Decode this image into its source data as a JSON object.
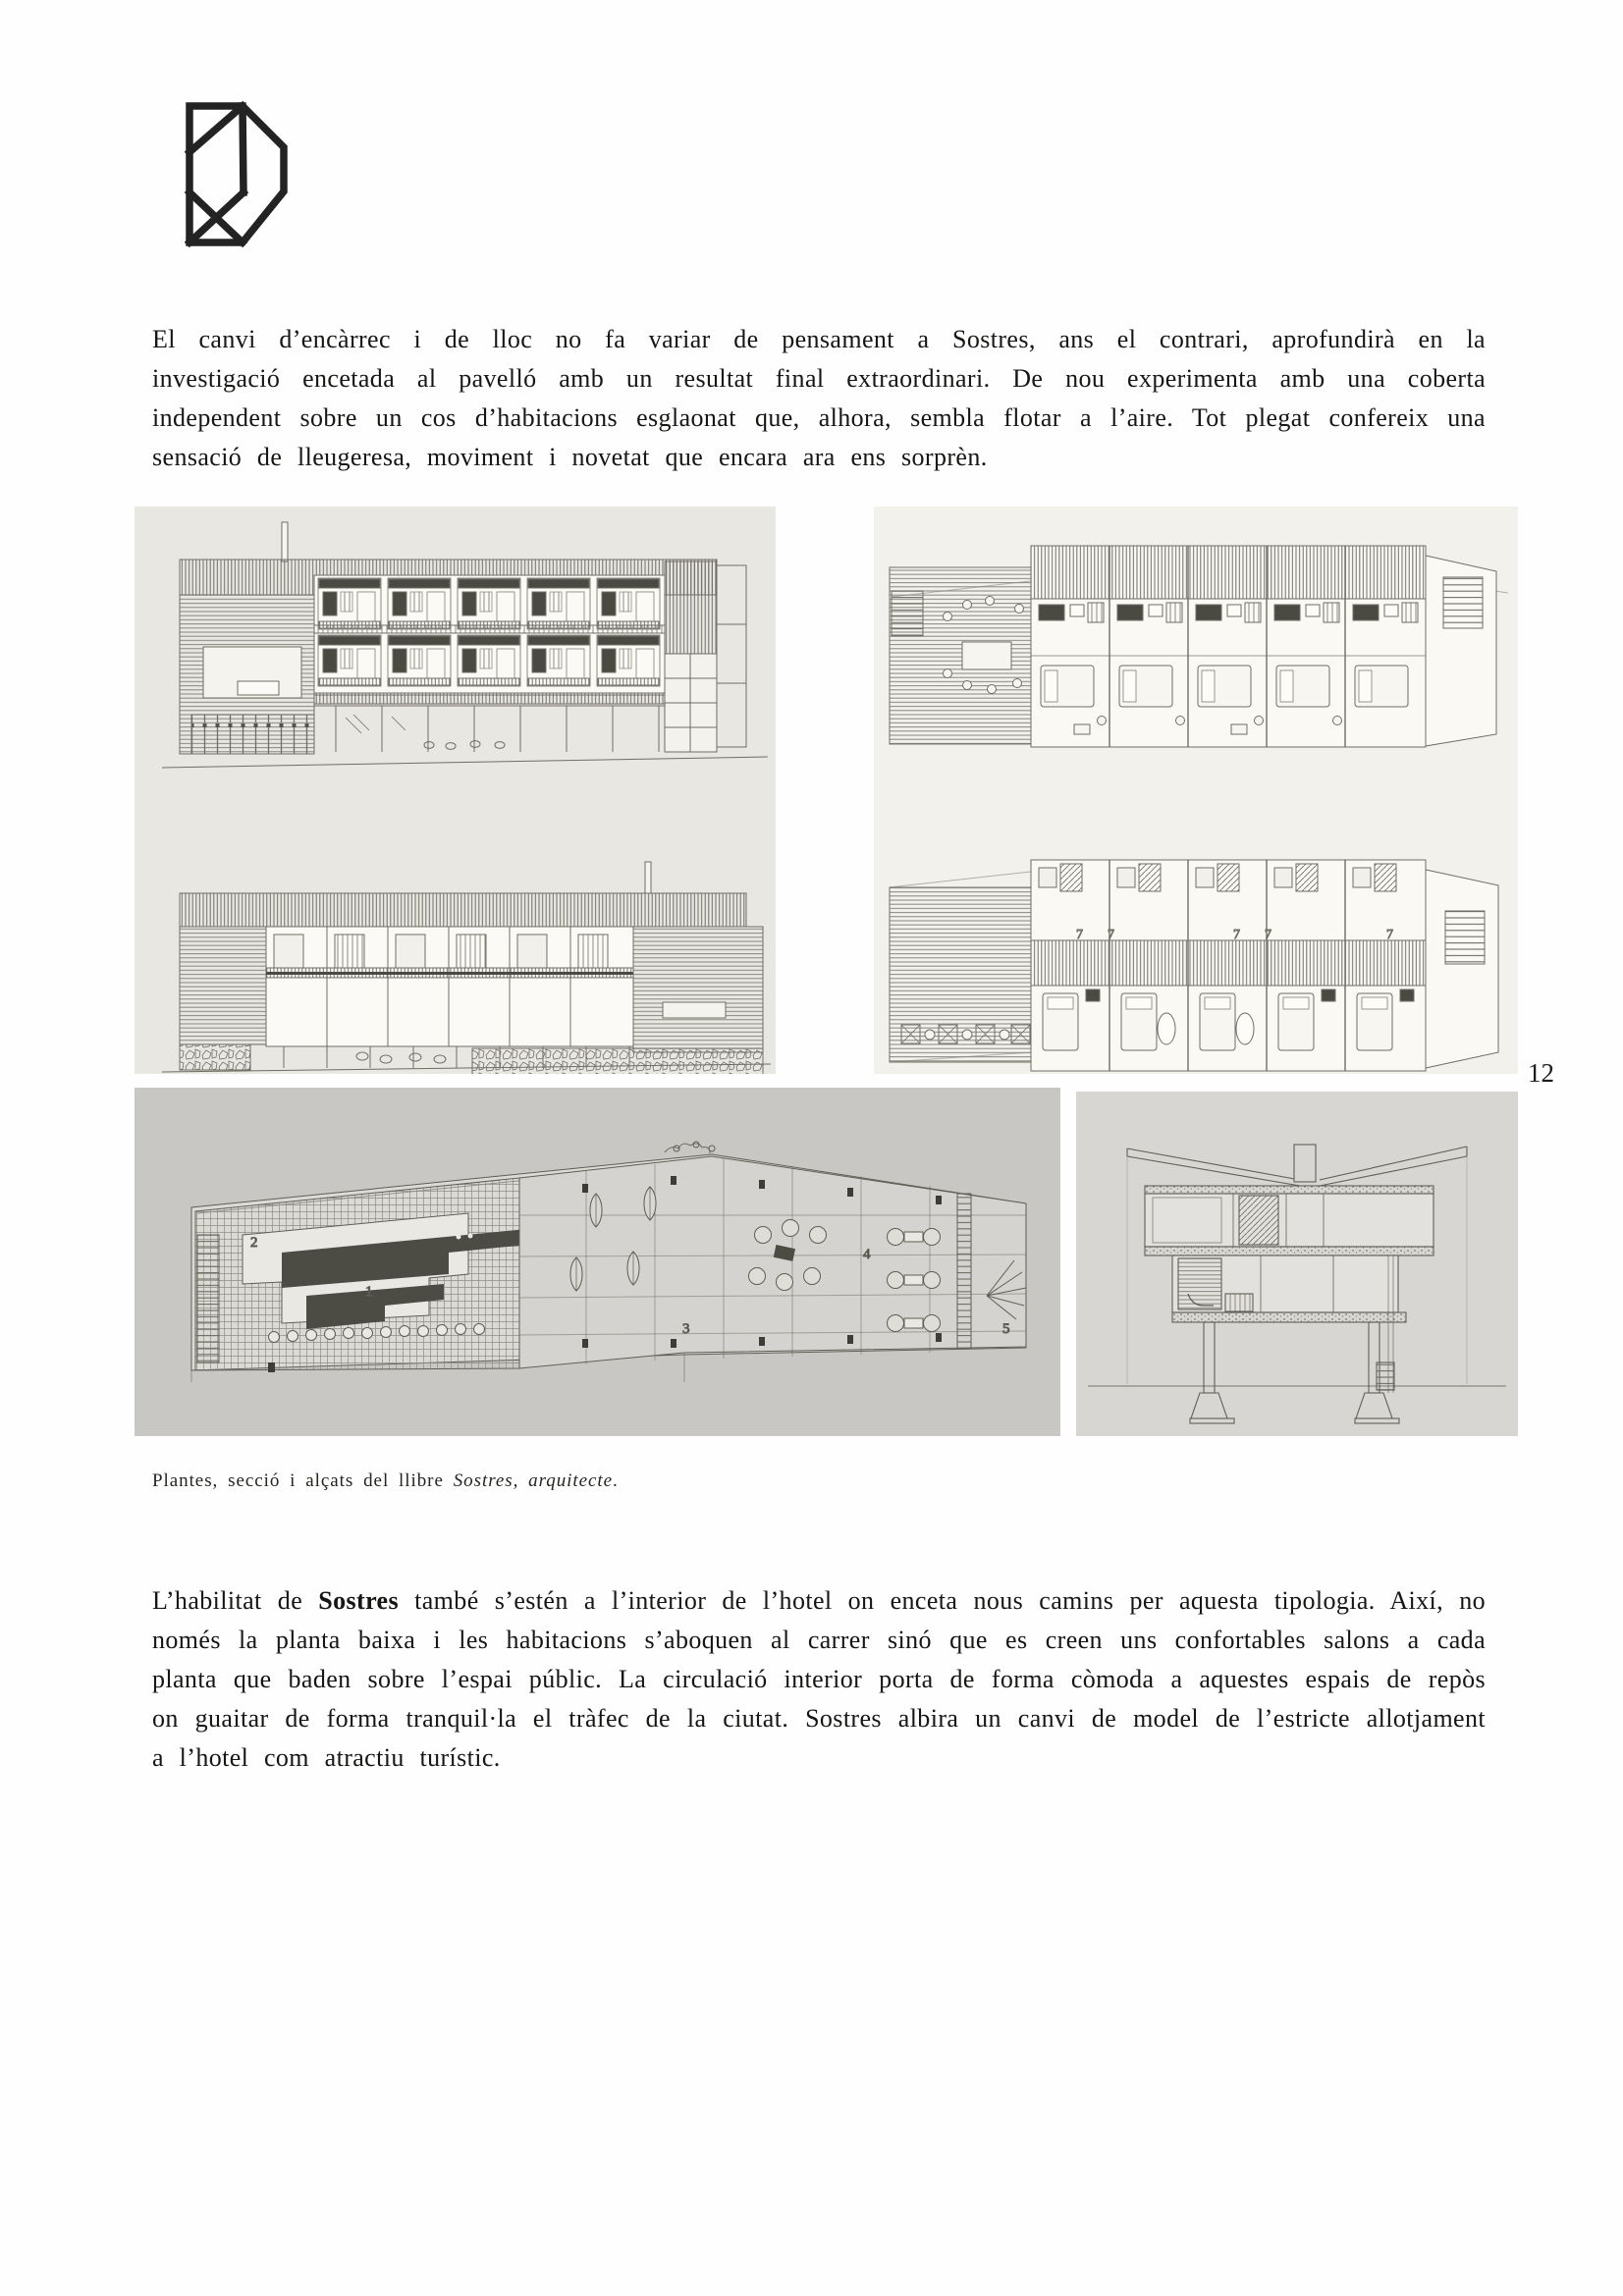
{
  "page": {
    "number": "12",
    "background": "#fefefe"
  },
  "icons": {
    "logo": "hexagonal-line-monogram"
  },
  "paragraph1": {
    "text": "El canvi d’encàrrec i de lloc no fa variar de pensament a Sostres, ans el contrari, aprofundirà en la investigació encetada al pavelló amb un resultat final extraordinari. De nou experimenta amb una coberta independent sobre un cos d’habitacions esglaonat que, alhora, sembla flotar a l’aire. Tot plegat confereix una sensació de lleugeresa, moviment i novetat que encara ara ens sorprèn."
  },
  "paragraph2": {
    "before_bold": "L’habilitat de ",
    "bold_word": "Sostres",
    "after_bold": " també s’estén a l’interior de l’hotel on enceta nous camins per aquesta tipologia. Així, no només la planta baixa i les habitacions s’aboquen al carrer sinó que es creen uns confortables salons a cada planta que baden sobre l’espai públic. La circulació interior porta de forma còmoda a aquestes espais de repòs on guaitar de forma tranquil·la el tràfec de la ciutat. Sostres albira un canvi de model de l’estricte allotjament a l’hotel com atractiu turístic."
  },
  "caption": {
    "prefix": "Plantes, secció i alçats del llibre ",
    "work_title": "Sostres, arquitecte",
    "suffix": "."
  },
  "figures": {
    "ground_plan_zone_labels": [
      "2",
      "1",
      "3",
      "4",
      "5"
    ],
    "room_labels": [
      "7",
      "7",
      "7",
      "7",
      "7"
    ]
  },
  "colors": {
    "panel_elevations_bg": "#e8e7e2",
    "panel_plans_bg": "#f2f1ec",
    "panel_ground_plan_bg": "#c8c7c3",
    "panel_section_bg": "#d7d6d2",
    "pencil_ink": "#6f6e64",
    "dark_fill": "#4a4942"
  }
}
